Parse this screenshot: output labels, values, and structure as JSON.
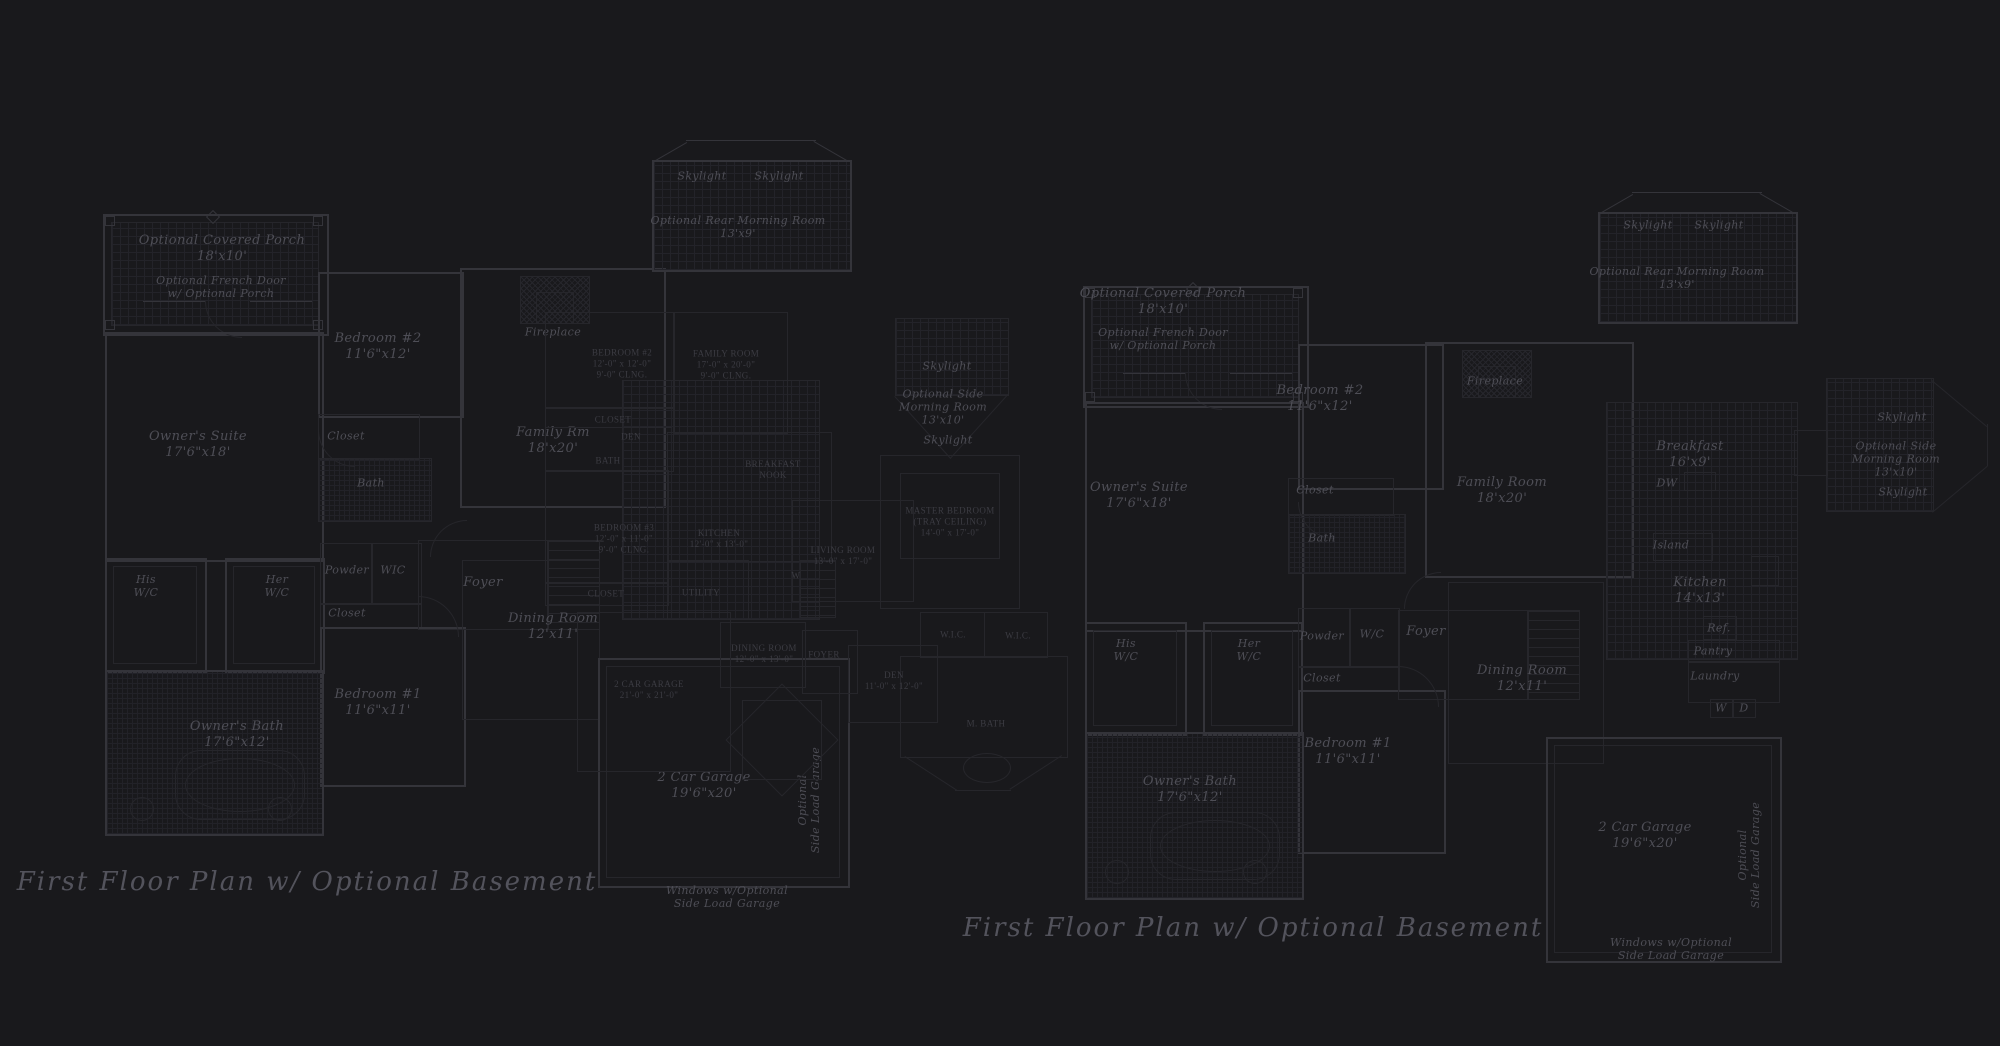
{
  "colors": {
    "background": "#19191c",
    "wall": "#34343a",
    "line": "#26262b",
    "label": "#4e4e56",
    "caps_label": "#3c3c43",
    "title": "#53535c"
  },
  "left_plan": {
    "title": "First Floor Plan  w/ Optional Basement",
    "labels": {
      "covered_porch": "Optional Covered Porch\n18'x10'",
      "french_door": "Optional French Door\nw/ Optional Porch",
      "bedroom2": "Bedroom #2\n11'6\"x12'",
      "owners_suite": "Owner's Suite\n17'6\"x18'",
      "closet_bedroom2": "Closet",
      "bath": "Bath",
      "his_wc": "His\nW/C",
      "her_wc": "Her\nW/C",
      "powder": "Powder",
      "wic": "WIC",
      "closet_hall": "Closet",
      "bedroom1": "Bedroom #1\n11'6\"x11'",
      "owners_bath": "Owner's Bath\n17'6\"x12'",
      "foyer": "Foyer",
      "fireplace": "Fireplace",
      "family_room": "Family Rm\n18'x20'",
      "dining_room": "Dining Room\n12'x11'",
      "skylight_left": "Skylight",
      "skylight_right": "Skylight",
      "rear_morning_room": "Optional Rear Morning Room\n13'x9'",
      "side_skylight_top": "Skylight",
      "side_morning_room": "Optional Side\nMorning Room\n13'x10'",
      "side_skylight_bottom": "Skylight",
      "garage": "2 Car Garage\n19'6\"x20'",
      "side_load_garage": "Optional\nSide Load Garage",
      "windows_note": "Windows w/Optional\nSide Load Garage"
    }
  },
  "right_plan": {
    "title": "First Floor Plan  w/ Optional Basement",
    "labels": {
      "covered_porch": "Optional Covered Porch\n18'x10'",
      "french_door": "Optional French Door\nw/ Optional Porch",
      "bedroom2": "Bedroom #2\n11'6\"x12'",
      "owners_suite": "Owner's Suite\n17'6\"x18'",
      "closet_bedroom2": "Closet",
      "bath": "Bath",
      "his_wc": "His\nW/C",
      "her_wc": "Her\nW/C",
      "powder": "Powder",
      "wic": "W/C",
      "closet_hall": "Closet",
      "bedroom1": "Bedroom #1\n11'6\"x11'",
      "owners_bath": "Owner's Bath\n17'6\"x12'",
      "foyer": "Foyer",
      "fireplace": "Fireplace",
      "family_room": "Family Room\n18'x20'",
      "breakfast": "Breakfast\n16'x9'",
      "dw": "DW",
      "island": "Island",
      "kitchen": "Kitchen\n14'x13'",
      "ref": "Ref.",
      "pantry": "Pantry",
      "laundry": "Laundry",
      "washer": "W",
      "dryer": "D",
      "dining_room": "Dining Room\n12'x11'",
      "skylight_left": "Skylight",
      "skylight_right": "Skylight",
      "rear_morning_room": "Optional Rear Morning Room\n13'x9'",
      "side_skylight_top": "Skylight",
      "side_morning_room": "Optional Side\nMorning Room\n13'x10'",
      "side_skylight_bottom": "Skylight",
      "garage": "2 Car Garage\n19'6\"x20'",
      "side_load_garage": "Optional\nSide Load Garage",
      "windows_note": "Windows w/Optional\nSide Load Garage"
    }
  },
  "overlay_plan": {
    "labels": {
      "bedroom2": "BEDROOM #2\n12'-0\" x 12'-0\"\n9'-0\" CLNG.",
      "family_room": "FAMILY ROOM\n17'-0\" x 20'-0\"\n9'-0\" CLNG.",
      "closet_a": "CLOSET",
      "den_small": "DEN",
      "bath": "BATH",
      "breakfast_nook": "BREAKFAST\nNOOK",
      "kitchen": "KITCHEN\n12'-0\" x 13'-0\"",
      "bedroom3": "BEDROOM #3\n12'-0\" x 11'-0\"\n9'-0\" CLNG.",
      "closet_b": "CLOSET",
      "living_room": "LIVING ROOM\n13'-0\" x 17'-0\"",
      "utility": "UTILITY",
      "washer": "W",
      "master_bedroom": "MASTER BEDROOM\n(TRAY CEILING)\n14'-0\" x 17'-0\"",
      "wic_a": "W.I.C.",
      "wic_b": "W.I.C.",
      "den": "DEN\n11'-0\" x 12'-0\"",
      "master_bath": "M. BATH",
      "dining_room": "DINING ROOM\n12'-0\" x 13'-0\"",
      "foyer": "FOYER",
      "garage": "2 CAR GARAGE\n21'-0\" x 21'-0\""
    }
  }
}
